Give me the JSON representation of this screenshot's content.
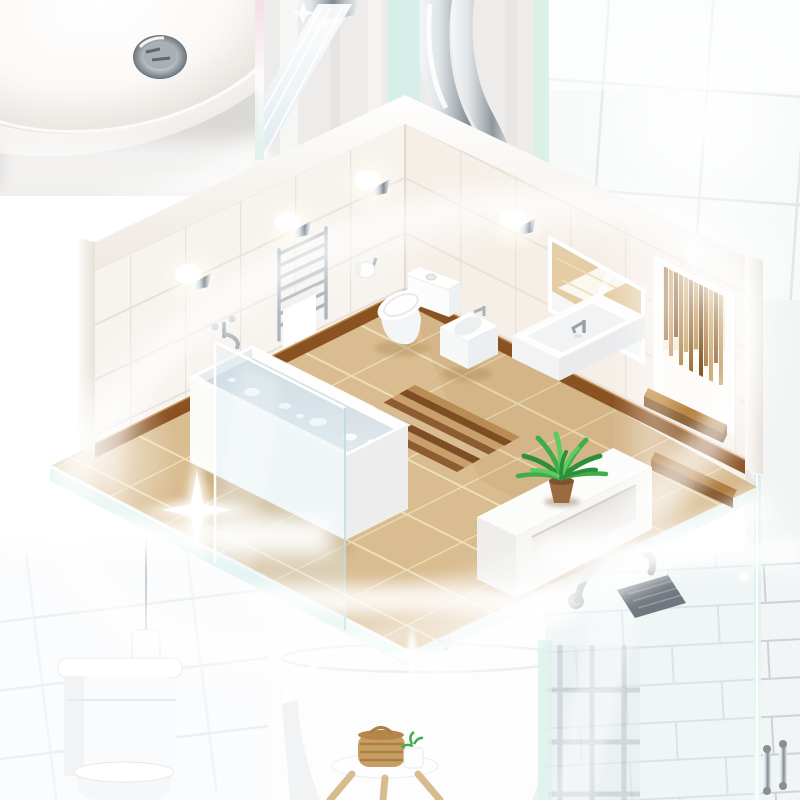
{
  "palette": {
    "floor_tile": "#d9bc90",
    "floor_grout": "#eedfbb",
    "wall_tile_left": "#f7f3ee",
    "wall_tile_right": "#f6efe8",
    "wall_grout": "#e9e1d8",
    "baseboard": "#8a5220",
    "wood_mid": "#a96f2e",
    "wood_dark": "#7c4a1c",
    "subway_tile": "#f2f5f6",
    "subway_grout": "#ccd2d6",
    "chrome": "#aeb6bc",
    "porcelain": "#fdfdfd",
    "water": "#cfd9df",
    "glass_mint": "#d9f1e9",
    "plant_green": "#3fae4a",
    "glow": "#ffffff"
  },
  "scene": {
    "style": "isometric-bathroom-collage",
    "photos": [
      {
        "id": "basin",
        "label": "round ceramic washbasin with chrome drain"
      },
      {
        "id": "faucet",
        "label": "chrome faucet with running water"
      },
      {
        "id": "wall-tiles",
        "label": "bright white tiled wall"
      },
      {
        "id": "toilet",
        "label": "white toilet with pendant cord lamp"
      },
      {
        "id": "bathtub",
        "label": "freestanding bathtub with wooden stool and wicker basket"
      },
      {
        "id": "shower",
        "label": "glass shower enclosure with square rain shower head"
      }
    ],
    "room": {
      "floor": "beige ceramic tile",
      "walls": "white ceramic tile",
      "fixtures": [
        "bathtub with water",
        "glass shower screen",
        "heated towel rail with towel",
        "wall sconce lights",
        "toilet",
        "toilet paper holder",
        "bidet",
        "wall-hung vanity sink",
        "mirror",
        "window with wooden blinds",
        "wooden window shelf",
        "wooden step",
        "striped runner rug",
        "white storage bench",
        "potted palm plant"
      ]
    }
  }
}
